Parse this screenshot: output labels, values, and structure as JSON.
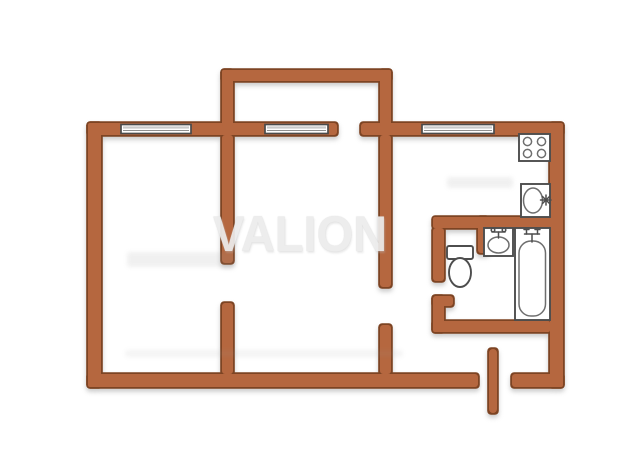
{
  "watermark": {
    "text": "VALION"
  },
  "plan": {
    "type": "apartment-floor-plan",
    "windows": [
      "window-left-room",
      "window-balcony-room",
      "window-kitchen"
    ],
    "openings": [
      "balcony-door-opening",
      "left-rooms-door-opening",
      "hall-door-opening",
      "bathroom-door-opening",
      "entrance-opening"
    ],
    "fixtures": [
      "stove",
      "kitchen-sink",
      "washbasin",
      "toilet",
      "bathtub"
    ],
    "features": [
      "balcony",
      "entrance-door-leaf"
    ]
  },
  "colors": {
    "wall-fill": "#b5673f",
    "wall-edge": "#7d4423",
    "window-frame": "#4a4a4a",
    "window-fill": "#ffffff",
    "window-pane": "#c9c9c9",
    "fixture-stroke": "#4d4d4d",
    "fixture-fill": "#ffffff",
    "fixture-detail": "#6e6e6e",
    "background": "#ffffff",
    "watermark": "#ececec"
  }
}
